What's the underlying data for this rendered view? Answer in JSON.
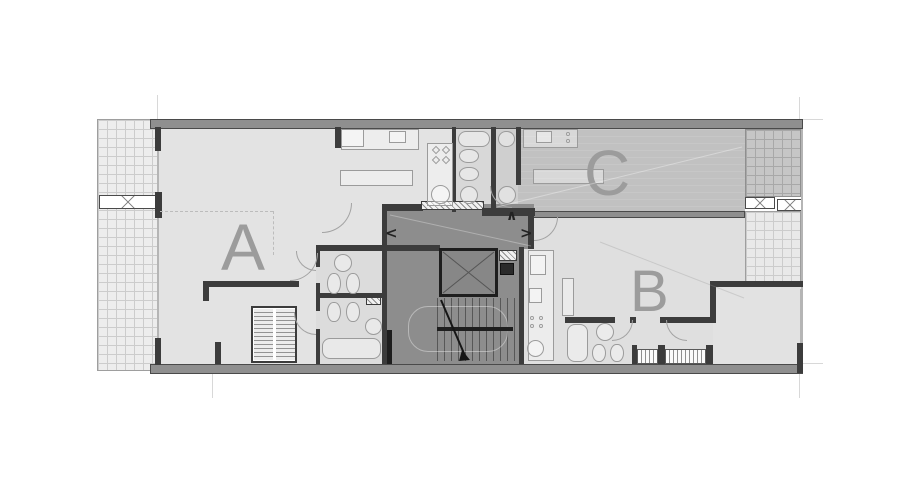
{
  "plan": {
    "units": [
      {
        "id": "A",
        "label": "A"
      },
      {
        "id": "B",
        "label": "B"
      },
      {
        "id": "C",
        "label": "C"
      }
    ],
    "core_arrows": {
      "up": "∧",
      "left": "<",
      "right": ">"
    }
  },
  "colors": {
    "floor-a": "#e3e3e3",
    "floor-b": "#dfdfdf",
    "floor-c": "#c1c1c1",
    "floor-bath": "#d8d8d8",
    "floor-bath2": "#cfcfcf",
    "core": "#8d8d8d",
    "terrace-a": "#ededed",
    "terrace-b": "#e9e9e9",
    "terrace-c": "#c6c6c6",
    "grid-a": "#cccccc",
    "grid-c": "#a8a8a8",
    "wall-fill": "#8f8f8f",
    "wall-stroke": "#4a4a4a",
    "wall-dark": "#3c3c3c",
    "wall-black": "#1e1e1e",
    "fixture-stroke": "#9b9b9b",
    "letter": "#9c9c9c",
    "arrow": "#222222",
    "ref-line": "#d8d8d8",
    "dashed": "#bcbcbc"
  }
}
